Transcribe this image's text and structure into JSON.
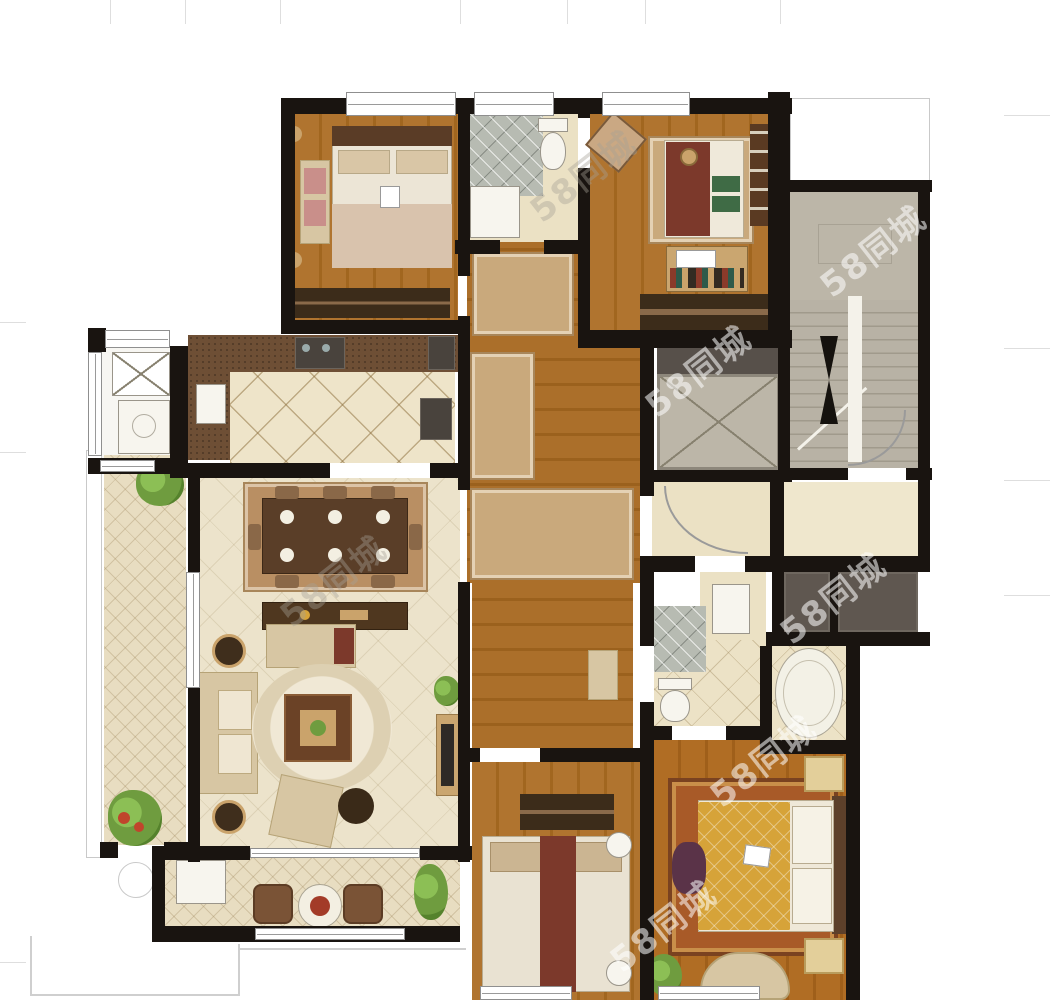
{
  "watermark": {
    "text": "58同城",
    "color": "rgba(255,255,255,0.55)",
    "rotation_deg": -38
  },
  "palette": {
    "wall": "#191410",
    "wood": "#aa6f2b",
    "wood2": "#9c6424",
    "tile": "#ece2c6",
    "tileLine": "#cdbd9b",
    "grayRoom": "#bcb6a8",
    "grayDark": "#5f5750",
    "counter": "#6e4f35",
    "rugTan": "#c3a277",
    "maroon": "#7c392b",
    "gold": "#d6a339",
    "green": "#6f9c3f",
    "beige": "#d7c6a3",
    "outline": "#c9c9c9"
  },
  "floorplan": {
    "type": "apartment-floor-plan-render",
    "rooms": [
      {
        "id": "bedroom-top-left",
        "floor": "wood"
      },
      {
        "id": "bathroom-top",
        "floor": "tile"
      },
      {
        "id": "bedroom-top-right",
        "floor": "wood"
      },
      {
        "id": "stairwell",
        "floor": "concrete"
      },
      {
        "id": "elevator-shaft",
        "floor": "concrete"
      },
      {
        "id": "service-balcony",
        "floor": "white"
      },
      {
        "id": "kitchen",
        "floor": "tile"
      },
      {
        "id": "hallway-foyer",
        "floor": "wood"
      },
      {
        "id": "entry-lobby",
        "floor": "tile"
      },
      {
        "id": "public-corridor",
        "floor": "tile"
      },
      {
        "id": "utility-shafts",
        "floor": "concrete"
      },
      {
        "id": "dining-living-room",
        "floor": "tile"
      },
      {
        "id": "side-balcony",
        "floor": "tile"
      },
      {
        "id": "master-bathroom",
        "floor": "tile"
      },
      {
        "id": "bedroom-bottom-middle",
        "floor": "wood"
      },
      {
        "id": "master-bedroom",
        "floor": "wood"
      },
      {
        "id": "bottom-balcony",
        "floor": "tile"
      }
    ],
    "fixtures": [
      "double-bed",
      "single-bed",
      "desk",
      "bookshelf",
      "wardrobe",
      "dining-table",
      "console-table",
      "sofa",
      "loveseat",
      "armchair",
      "coffee-table",
      "tv-console",
      "bathtub",
      "toilet",
      "shower",
      "sink",
      "washing-machine",
      "drying-rack",
      "stairs-with-arrow",
      "elevator-car",
      "plants",
      "door-swing-arcs",
      "balcony-chairs",
      "round-table"
    ]
  }
}
